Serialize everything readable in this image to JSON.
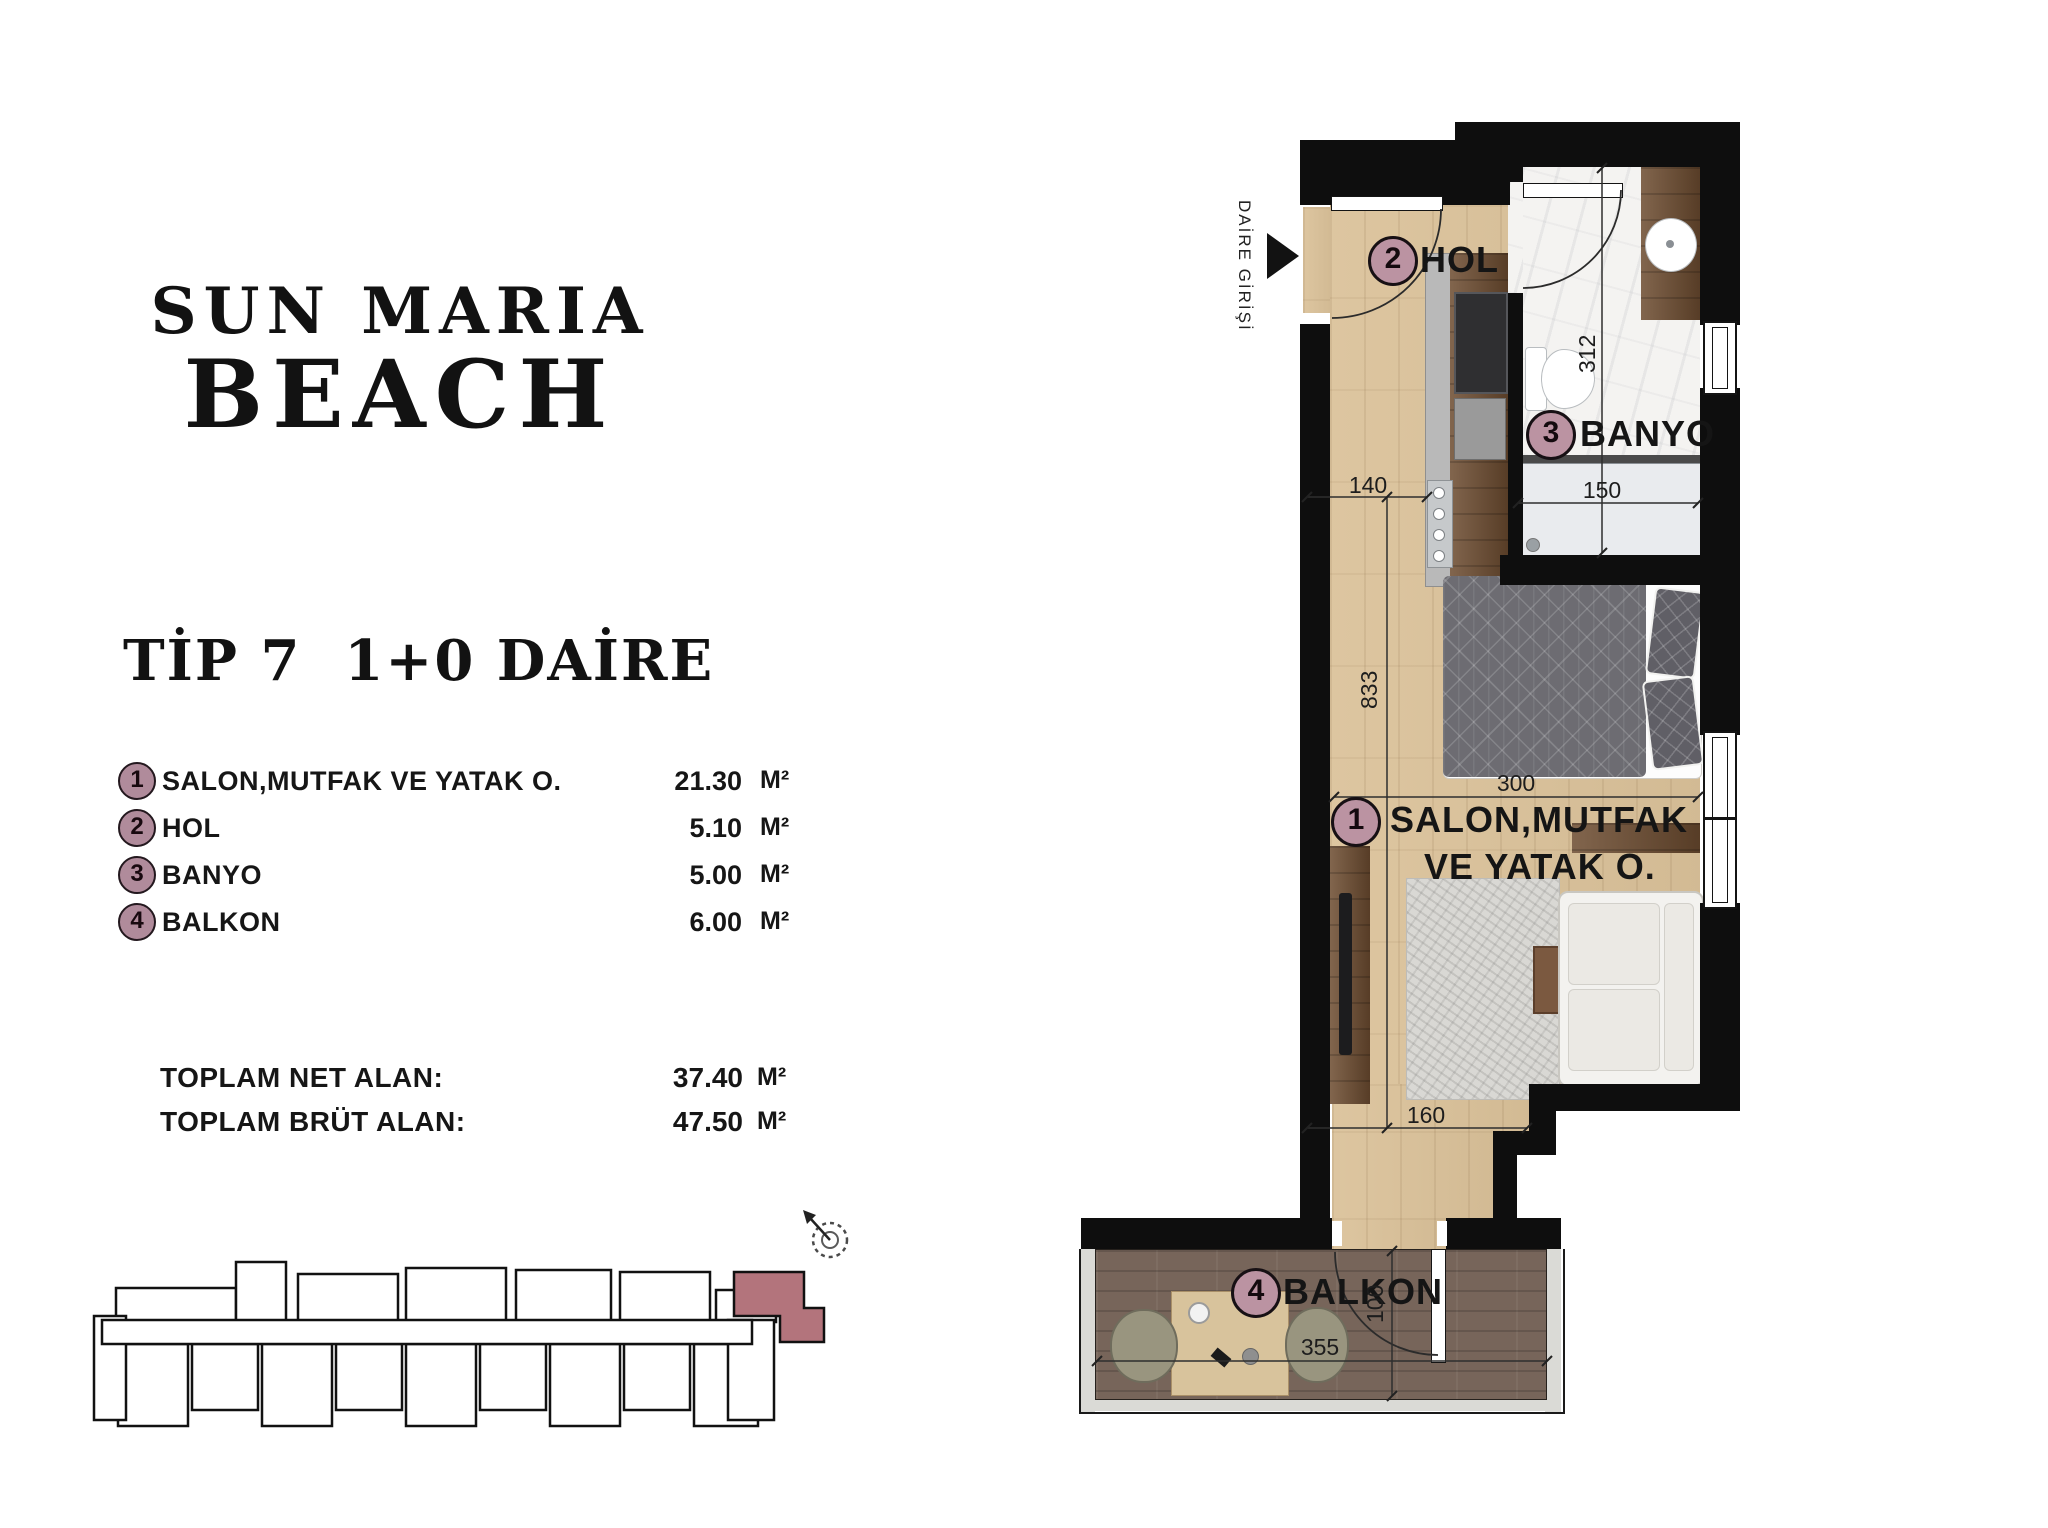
{
  "brand": {
    "line1": "SUN MARIA",
    "line2": "BEACH"
  },
  "unit": {
    "heading": "TİP 7  1+0 DAİRE"
  },
  "legend": {
    "items": [
      {
        "num": "1",
        "label": "SALON,MUTFAK VE YATAK O.",
        "value": "21.30",
        "unit": "M²"
      },
      {
        "num": "2",
        "label": "HOL",
        "value": "5.10",
        "unit": "M²"
      },
      {
        "num": "3",
        "label": "BANYO",
        "value": "5.00",
        "unit": "M²"
      },
      {
        "num": "4",
        "label": "BALKON",
        "value": "6.00",
        "unit": "M²"
      }
    ],
    "totals": [
      {
        "label": "TOPLAM NET ALAN:",
        "value": "37.40",
        "unit": "M²"
      },
      {
        "label": "TOPLAM BRÜT ALAN:",
        "value": "47.50",
        "unit": "M²"
      }
    ]
  },
  "plan": {
    "entrance_label": "DAİRE GİRİŞİ",
    "rooms": {
      "salon": {
        "num": "1",
        "line1": "SALON,MUTFAK",
        "line2": "VE YATAK O."
      },
      "hol": {
        "num": "2",
        "label": "HOL"
      },
      "banyo": {
        "num": "3",
        "label": "BANYO"
      },
      "balkon": {
        "num": "4",
        "label": "BALKON"
      }
    },
    "dims": {
      "hall_width": "140",
      "bath_width": "150",
      "bath_length": "312",
      "salon_length": "833",
      "bed_wall": "300",
      "tv_wall": "160",
      "balcony_length": "355",
      "balcony_depth": "100"
    }
  },
  "colors": {
    "badge": "#b08b9b",
    "keyplan_highlight": "#b3747c",
    "wall": "#0e0e0e",
    "wood_floor": "#dbc29a",
    "balcony_deck": "#77655a"
  }
}
